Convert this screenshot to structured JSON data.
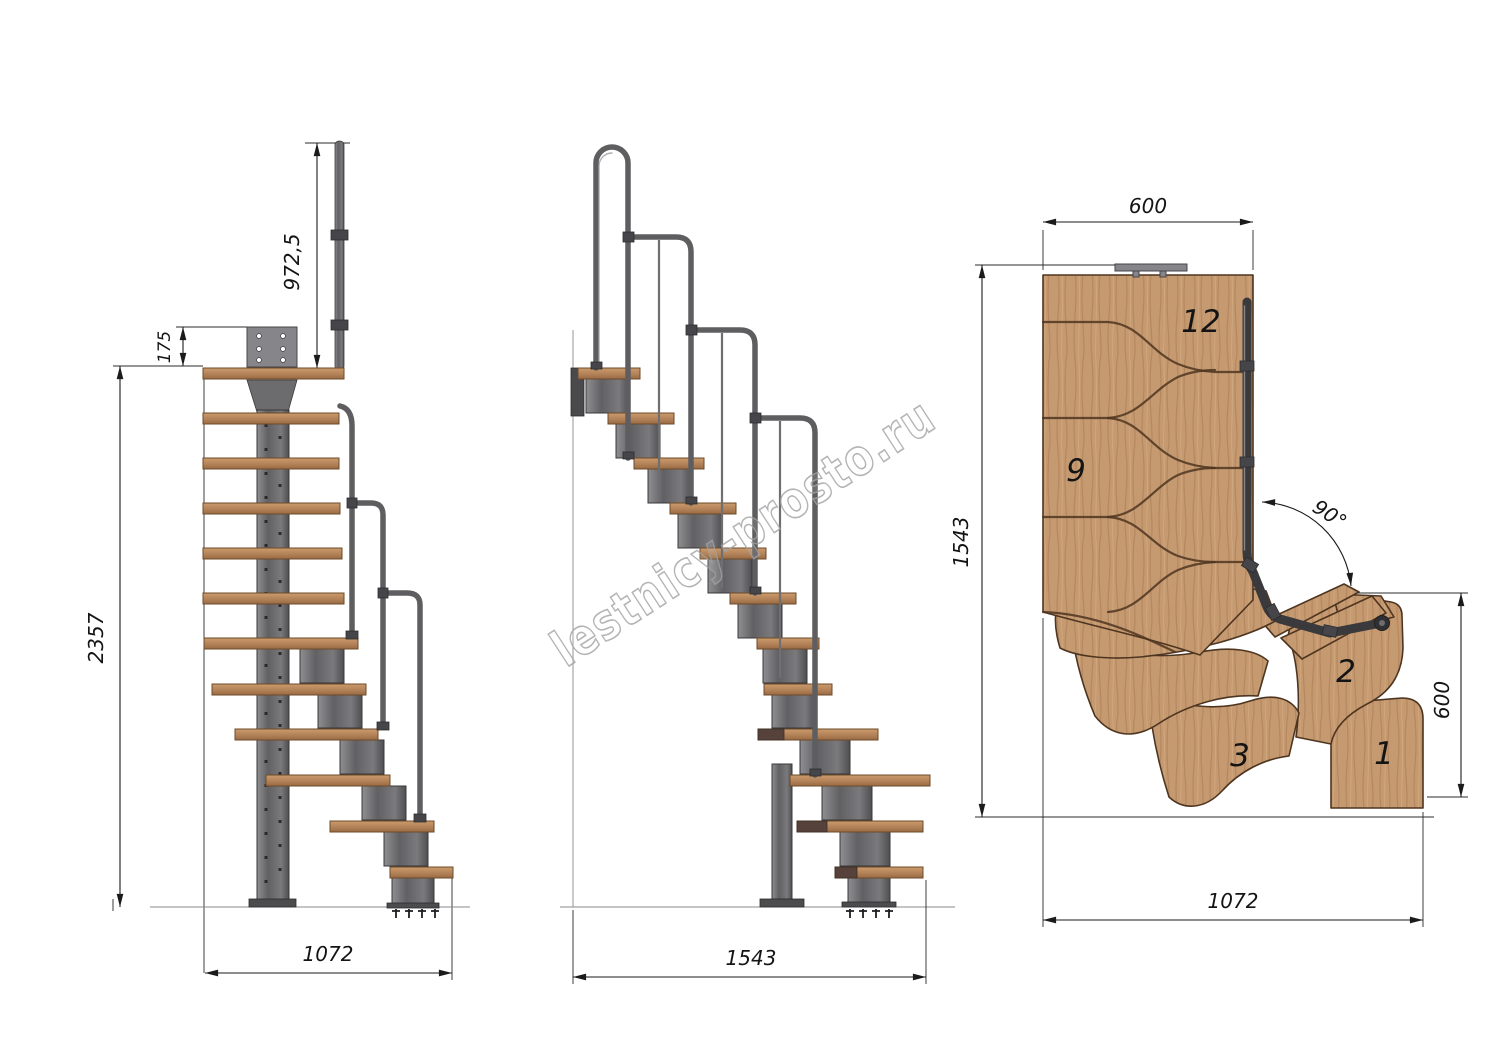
{
  "drawing": {
    "watermark": "lestnicy-prosto.ru",
    "colors": {
      "wood": "#c69a71",
      "wood_outline": "#4e3520",
      "metal": "#6f6f72",
      "rail": "#5e5e61",
      "plan_rail": "#3a3a3d",
      "dimension": "#1b1b1b",
      "watermark": "#a2a2a2",
      "background": "#ffffff"
    },
    "side_view": {
      "dim_handrail_height": "972,5",
      "dim_plate_height": "175",
      "dim_total_height": "2357",
      "dim_depth": "1072"
    },
    "front_view": {
      "dim_width": "1543"
    },
    "plan_view": {
      "dim_flight_width": "600",
      "dim_plan_length": "1543",
      "dim_exit_width": "600",
      "dim_plan_width": "1072",
      "dim_turn_angle": "90°",
      "step_12": "12",
      "step_9": "9",
      "step_3": "3",
      "step_2": "2",
      "step_1": "1"
    }
  }
}
